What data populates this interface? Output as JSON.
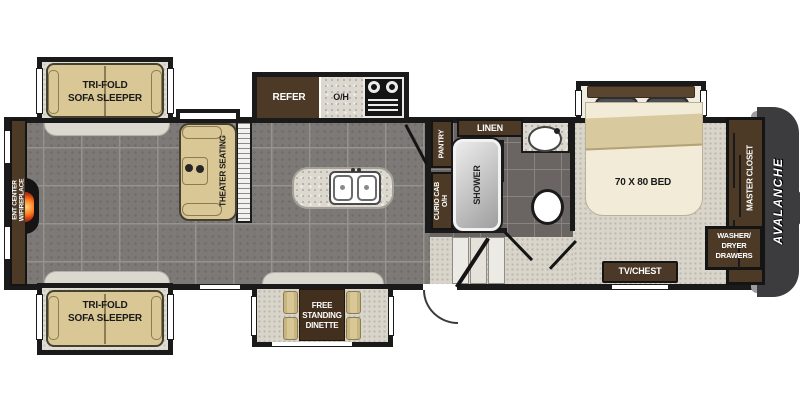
{
  "plan": {
    "brand": "AVALANCHE",
    "labels": {
      "sofa_top": [
        "TRI-FOLD",
        "SOFA SLEEPER"
      ],
      "sofa_bottom": [
        "TRI-FOLD",
        "SOFA SLEEPER"
      ],
      "ent_center": [
        "ENT CENTER",
        "W/FIREPLACE"
      ],
      "theater": "THEATER SEATING",
      "refer": "REFER",
      "overhead": "O/H",
      "pantry": "PANTRY",
      "curio": [
        "CURIO CAB",
        "O/H"
      ],
      "linen": "LINEN",
      "shower": "SHOWER",
      "bed": "70 X 80 BED",
      "master_closet": "MASTER CLOSET",
      "washer_dryer": [
        "WASHER/",
        "DRYER",
        "DRAWERS"
      ],
      "tv_chest": "TV/CHEST",
      "dinette": [
        "FREE",
        "STANDING",
        "DINETTE"
      ]
    },
    "colors": {
      "wall": "#1a1a1a",
      "cabinet_brown": "#4d3a26",
      "sofa_tan": "#d9c795",
      "floor_tile": "#7c7976",
      "bath_tile": "#6a6562",
      "carpet_beige": "#d9d5cb",
      "counter_granite": "#dcd8d0",
      "front_cap": "#3c3c3f",
      "flame_orange": "#ff7a1e"
    }
  }
}
